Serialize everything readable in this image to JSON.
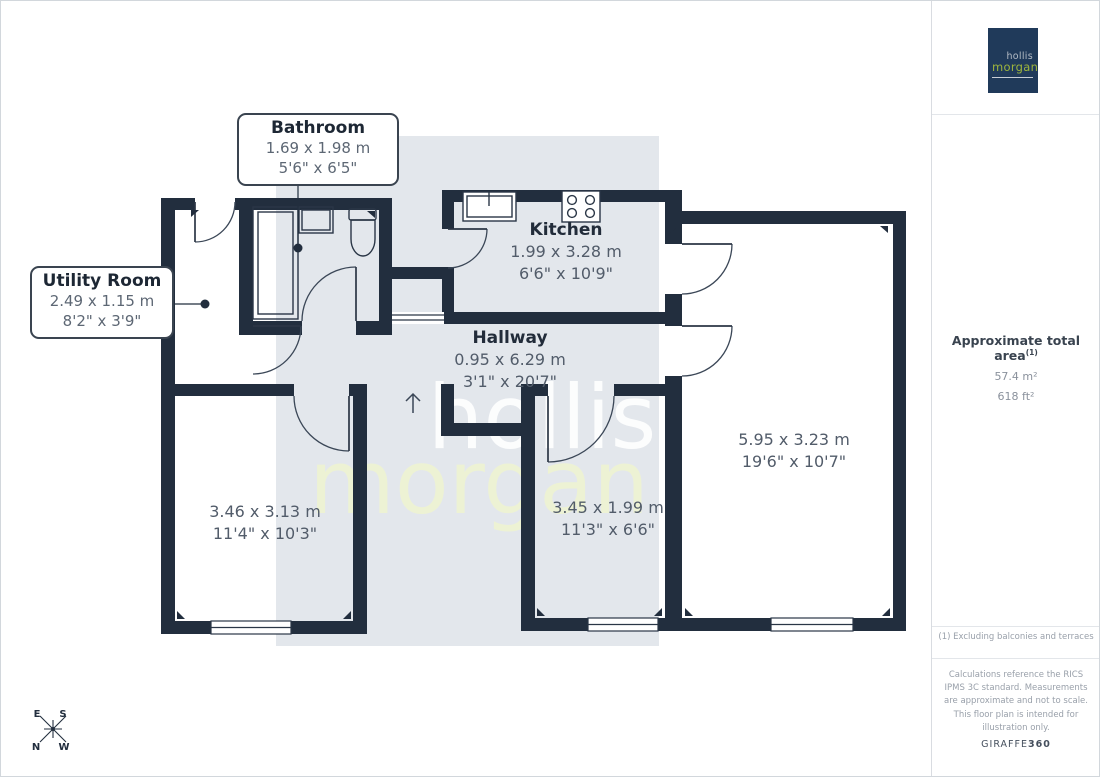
{
  "plan": {
    "rooms": {
      "bathroom": {
        "name": "Bathroom",
        "metric": "1.69 x 1.98 m",
        "imperial": "5'6\" x 6'5\""
      },
      "utility_room": {
        "name": "Utility Room",
        "metric": "2.49 x 1.15 m",
        "imperial": "8'2\" x 3'9\""
      },
      "kitchen": {
        "name": "Kitchen",
        "metric": "1.99 x 3.28 m",
        "imperial": "6'6\" x 10'9\""
      },
      "hallway": {
        "name": "Hallway",
        "metric": "0.95 x 6.29 m",
        "imperial": "3'1\" x 20'7\""
      },
      "room_bottom_left": {
        "metric": "3.46 x 3.13 m",
        "imperial": "11'4\" x 10'3\""
      },
      "room_bottom_middle": {
        "metric": "3.45 x 1.99 m",
        "imperial": "11'3\" x 6'6\""
      },
      "room_right": {
        "metric": "5.95 x 3.23 m",
        "imperial": "19'6\" x 10'7\""
      }
    },
    "compass": {
      "e": "E",
      "s": "S",
      "n": "N",
      "w": "W"
    },
    "watermark": {
      "line1": "hollis",
      "line2": "morgan"
    }
  },
  "sidebar": {
    "logo": {
      "line1": "hollis",
      "line2": "morgan"
    },
    "area": {
      "title": "Approximate total area",
      "note_marker": "(1)",
      "metric": "57.4 m²",
      "imperial": "618 ft²"
    },
    "footnote": "(1) Excluding balconies and terraces",
    "disclaimer": "Calculations reference the RICS IPMS 3C standard. Measurements are approximate and not to scale. This floor plan is intended for illustration only.",
    "credit": {
      "name": "GIRAFFE",
      "number": "360"
    }
  },
  "colors": {
    "wall": "#222e3e",
    "watermark_bg": "#e3e7ec",
    "watermark_green": "#eef3d3",
    "logo_navy": "#203a5a",
    "logo_green": "#9db43d"
  }
}
